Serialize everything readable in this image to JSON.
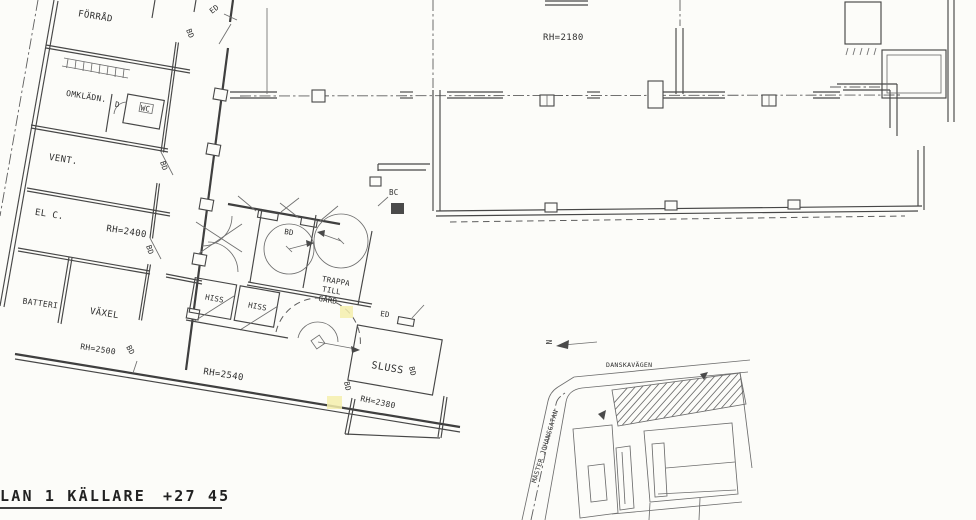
{
  "drawing_title": {
    "label": "LAN 1 KÄLLARE",
    "elevation": "+27 45"
  },
  "rooms": {
    "forrad": "FÖRRÅD",
    "omkladn": "OMKLÄDN.",
    "dusch": "D",
    "wc": "WC",
    "vent": "VENT.",
    "el_central": "EL C.",
    "batteri": "BATTERI",
    "vaxel": "VÄXEL",
    "hiss_1": "HISS",
    "hiss_2": "HISS",
    "trappa_1": "TRAPPA",
    "trappa_2": "TILL",
    "trappa_3": "GÅRD",
    "sluss": "SLUSS"
  },
  "ceiling_heights": {
    "hall": "RH=2180",
    "el_central": "RH=2400",
    "vaxel": "RH=2500",
    "core": "RH=2540",
    "sluss": "RH=2380"
  },
  "door_marks": {
    "ed_1": "ED",
    "ed_2": "ED",
    "bd_1": "BD",
    "bd_2": "BD",
    "bd_3": "BD",
    "bd_4": "BD",
    "bd_5": "BD",
    "bd_6": "BD",
    "bd_7": "BD",
    "bc": "BC"
  },
  "site_plan": {
    "street_top": "DANSKAVÄGEN",
    "street_left": "MÄSTER JOHANSGATAN",
    "north_mark": "N"
  },
  "colors": {
    "paper": "#fcfcf9",
    "ink": "#3f3f3f",
    "ink_light": "#6e6e6e",
    "highlight": "#f5efad"
  }
}
